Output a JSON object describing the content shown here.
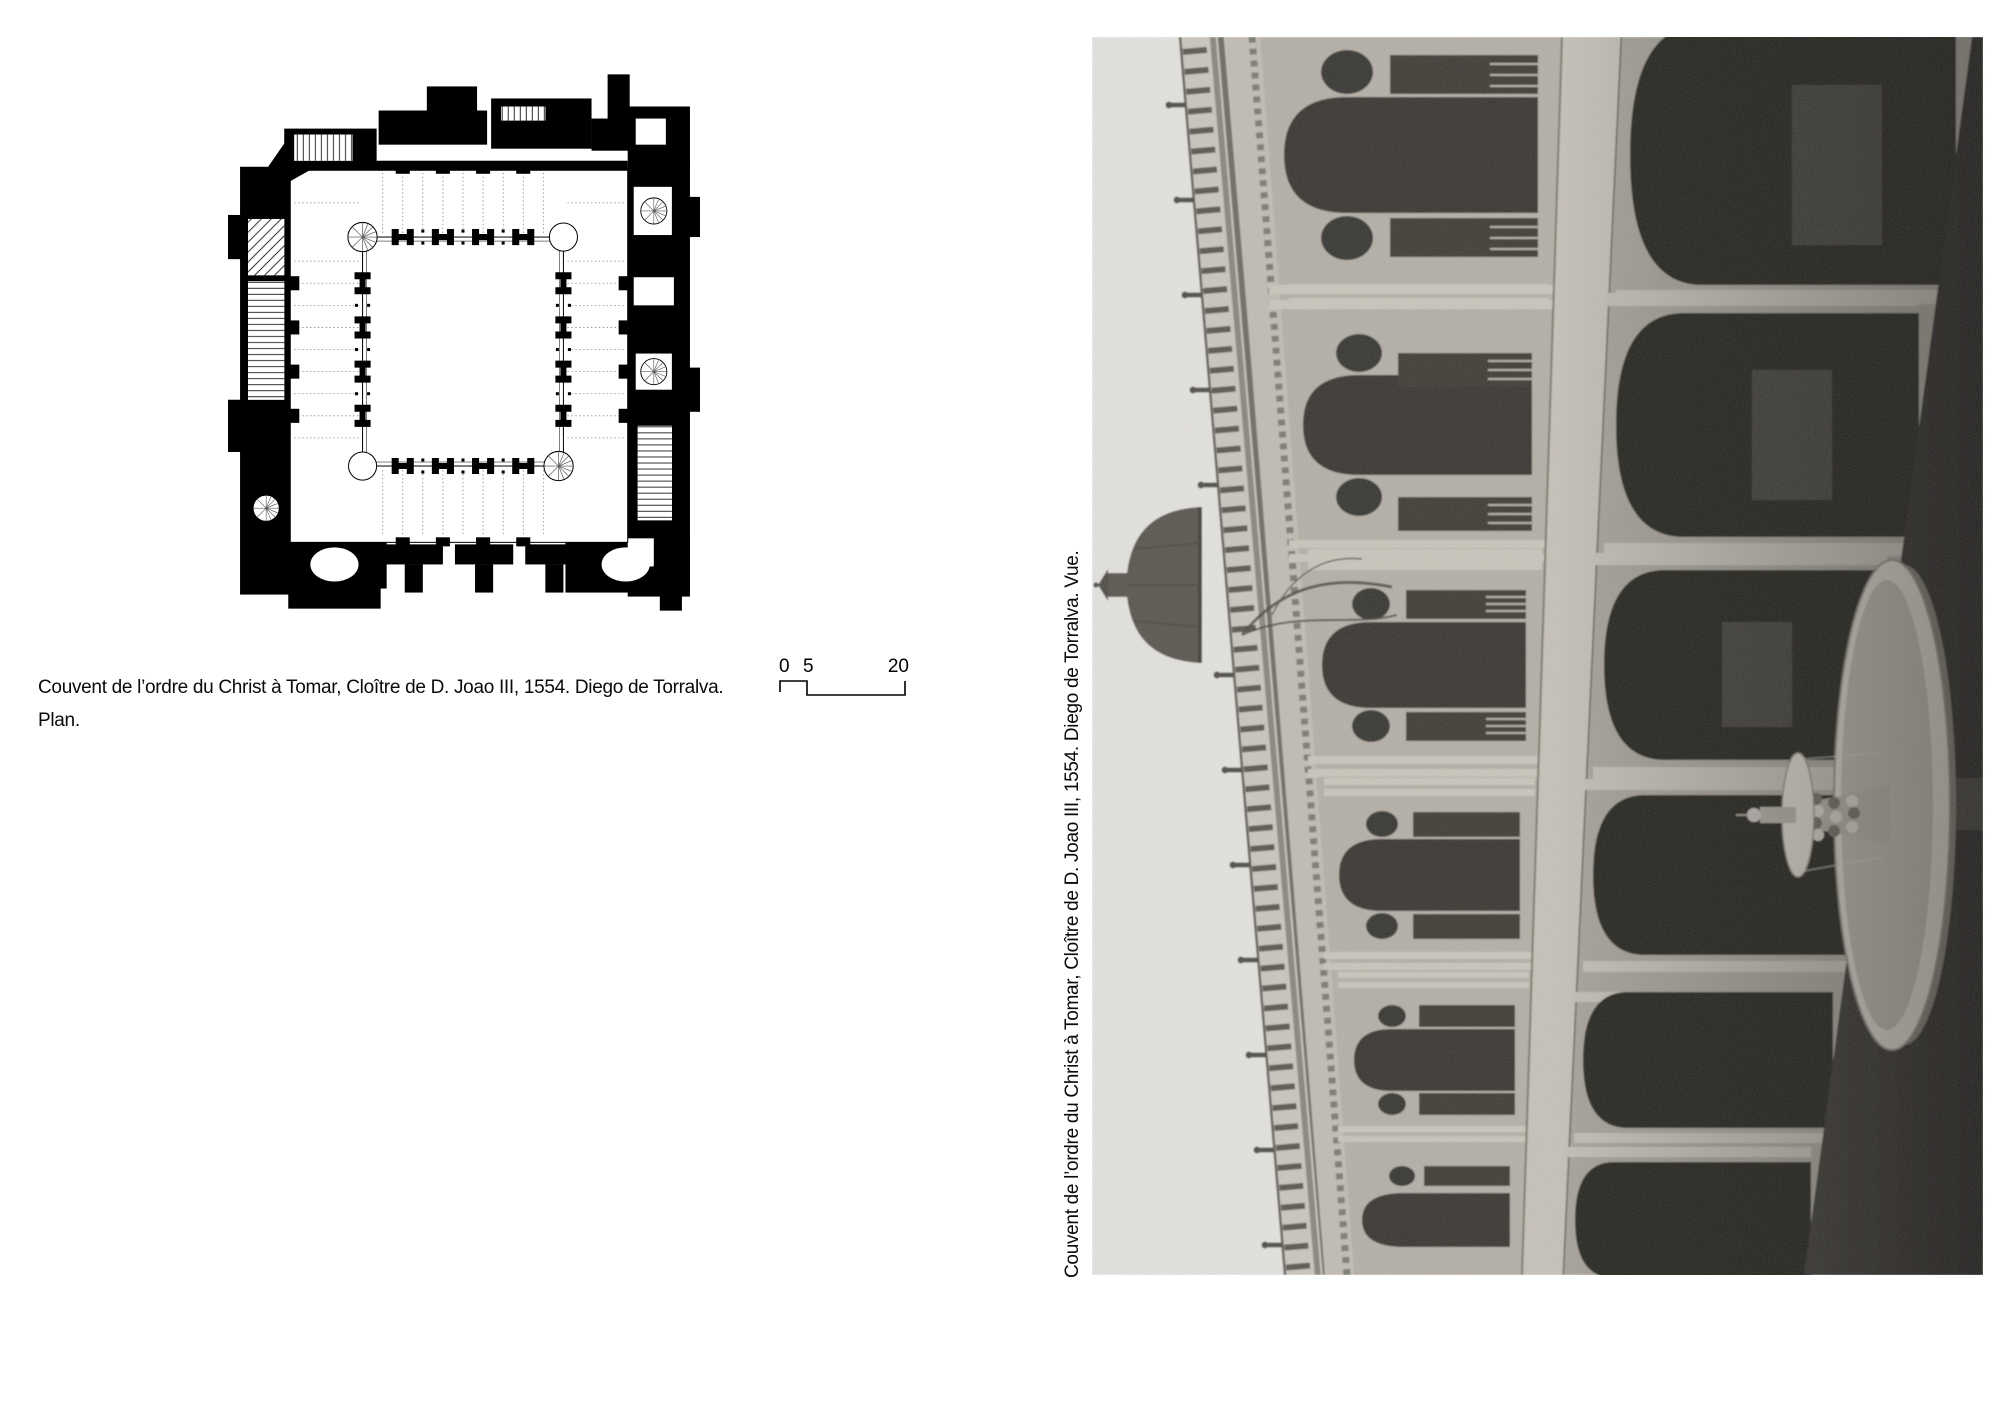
{
  "plan_figure": {
    "caption_lines": [
      "Couvent de l’ordre du Christ à Tomar, Cloître de D. Joao III, 1554. Diego de Torralva.",
      "Plan."
    ],
    "scale_bar": {
      "labels": [
        "0",
        "5",
        "20"
      ]
    }
  },
  "photo_figure": {
    "caption": "Couvent de l’ordre du Christ à Tomar, Cloître de D. Joao III, 1554. Diego de Torralva. Vue."
  },
  "colors": {
    "paper": "#ffffff",
    "ink": "#000000",
    "photo_sky": "#e6e5e1",
    "photo_stone": "#b5b0a7",
    "photo_shadow": "#21201e"
  }
}
